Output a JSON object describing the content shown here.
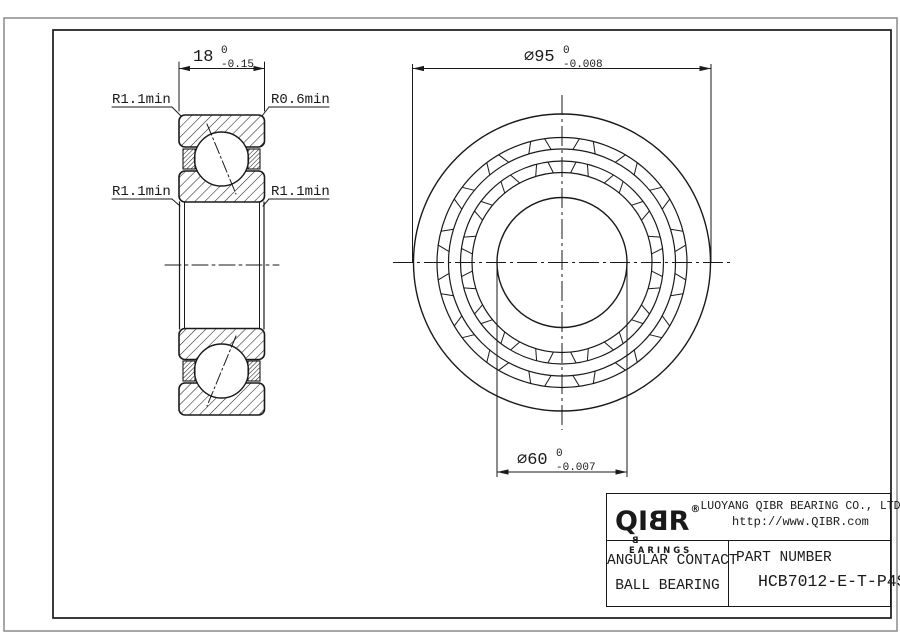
{
  "left_view": {
    "dim_width": {
      "text": "18",
      "tol_upper": "0",
      "tol_lower": "-0.15"
    },
    "labels": {
      "top_left": "R1.1min",
      "top_right": "R0.6min",
      "mid_left": "R1.1min",
      "mid_right": "R1.1min"
    }
  },
  "front_view": {
    "dim_outer": {
      "text": "⌀95",
      "tol_upper": "0",
      "tol_lower": "-0.008"
    },
    "dim_bore": {
      "text": "⌀60",
      "tol_upper": "0",
      "tol_lower": "-0.007"
    }
  },
  "title_block": {
    "logo_prefix": "QI",
    "logo_flipped": "B",
    "logo_suffix": "R",
    "registered": "®",
    "brand_sub_flipped": "B",
    "brand_sub_rest": "EARINGS",
    "company": "LUOYANG QIBR BEARING CO., LTD",
    "website": "http://www.QIBR.com",
    "product_line1": "ANGULAR CONTACT",
    "product_line2": "BALL BEARING",
    "part_number_label": "PART NUMBER",
    "part_number": "HCB7012-E-T-P4S"
  }
}
